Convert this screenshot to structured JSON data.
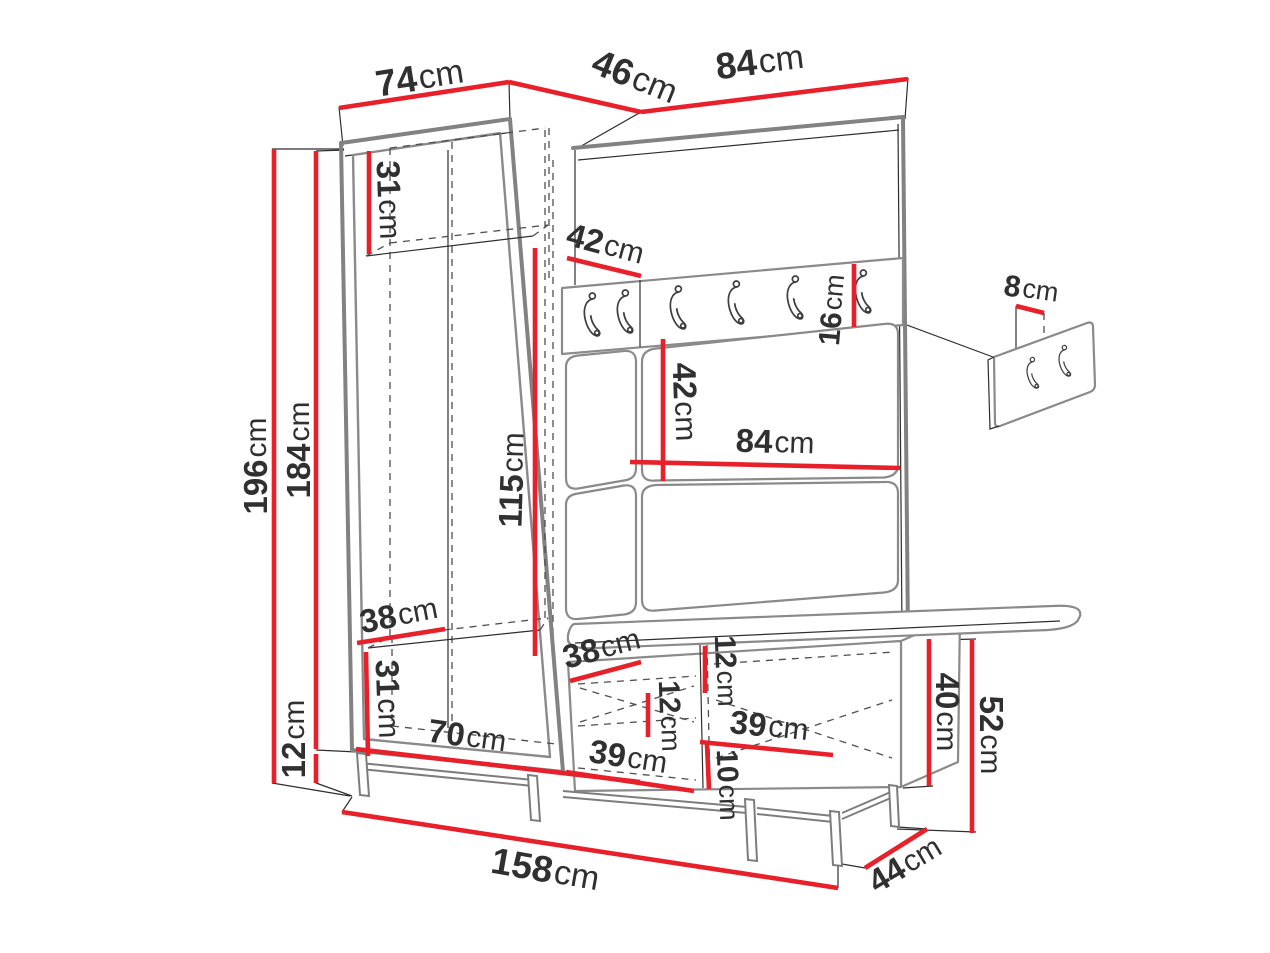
{
  "diagram": {
    "type": "furniture-dimension-drawing",
    "unit": "cm",
    "colors": {
      "dimension_line": "#e8202a",
      "main_outline": "#828282",
      "thin_line": "#2e2e2e",
      "label_text": "#303030",
      "background": "#ffffff"
    },
    "furniture": {
      "parts": [
        "wardrobe",
        "corner-coat-hook-panel",
        "bench-shoe-cabinet",
        "wall-hook-panel-detail"
      ],
      "main_hook_count": 6,
      "detail_hook_count": 2
    },
    "dimensions": {
      "total_height": "196",
      "body_height": "184",
      "legs_height": "12",
      "top_width_wardrobe": "74",
      "top_width_corner": "46",
      "top_width_panel": "84",
      "wardrobe_top_shelf_height": "31",
      "wardrobe_side_depth": "42",
      "hook_rail_height": "16",
      "panel_upper_section_height": "42",
      "panel_inner_width": "84",
      "wall_panel_hook_spacing": "8",
      "wardrobe_hanging_height": "115",
      "wardrobe_bottom_depth": "38",
      "wardrobe_bottom_shelf_height": "31",
      "wardrobe_inner_width": "70",
      "bench_top_depth": "38",
      "bench_top_section_height": "12",
      "bench_drawer_height": "12",
      "bench_left_compartment_width": "39",
      "bench_right_compartment_width": "39",
      "bench_bottom_section_height": "10",
      "bench_body_height": "40",
      "bench_total_height": "52",
      "bench_depth": "44",
      "total_width": "158"
    }
  }
}
